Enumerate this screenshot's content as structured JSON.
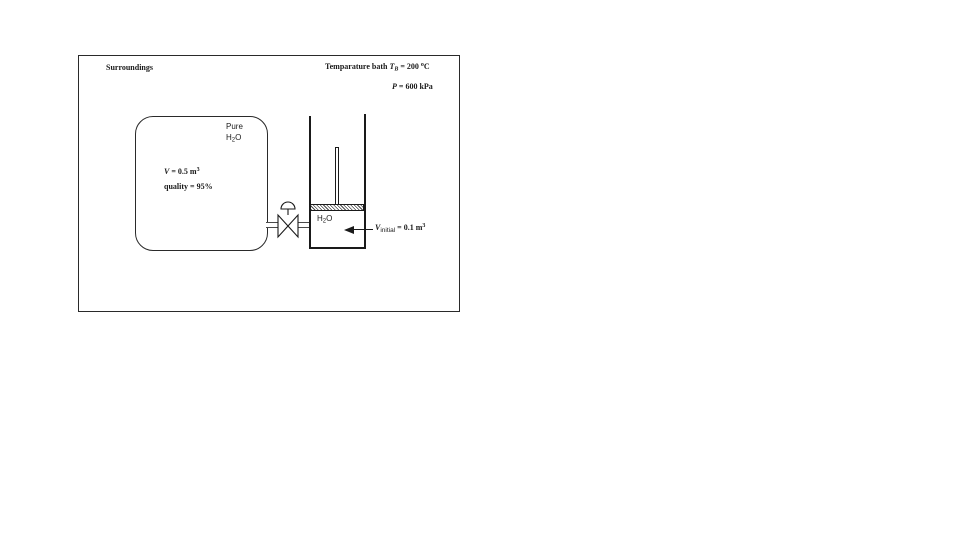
{
  "colors": {
    "ink": "#1a1a1a",
    "pipe_line": "#4a4a4a",
    "background": "#ffffff"
  },
  "surroundings": {
    "label": "Surroundings"
  },
  "bath": {
    "prefix": "Temparature bath ",
    "var": "T",
    "var_sub": "B",
    "value": " = 200 ",
    "deg": "o",
    "unit": "C"
  },
  "pressure": {
    "var": "P",
    "value": " = 600 kPa"
  },
  "tank": {
    "line1": "Pure",
    "h2o": {
      "H": "H",
      "two": "2",
      "O": "O"
    },
    "volume": {
      "var": "V",
      "value": " = 0.5 m",
      "exp": "3"
    },
    "quality": "quality = 95%"
  },
  "cylinder": {
    "h2o": {
      "H": "H",
      "two": "2",
      "O": "O"
    },
    "initial": {
      "var": "V",
      "sub": "initial",
      "value": " = 0.1 m",
      "exp": "3"
    }
  }
}
